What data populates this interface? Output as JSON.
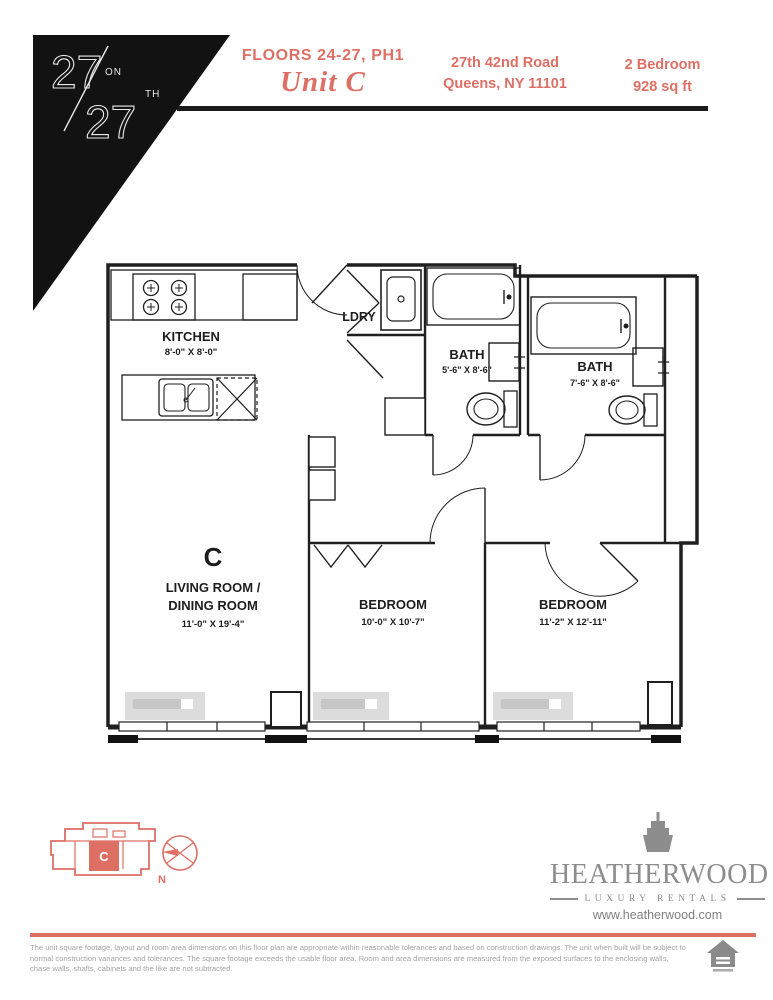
{
  "header": {
    "logo_num1": "27",
    "logo_sub1": "ON",
    "logo_num2": "27",
    "logo_sub2": "TH",
    "floors": "FLOORS 24-27, PH1",
    "unit": "Unit C",
    "address_line1": "27th 42nd Road",
    "address_line2": "Queens, NY 11101",
    "info_line1": "2 Bedroom",
    "info_line2": "928 sq ft"
  },
  "floorplan": {
    "kitchen": {
      "label": "KITCHEN",
      "dims": "8'-0\" X 8'-0\""
    },
    "laundry": {
      "label": "LDRY"
    },
    "bath1": {
      "label": "BATH",
      "dims": "5'-6\" X 8'-6\""
    },
    "bath2": {
      "label": "BATH",
      "dims": "7'-6\" X 8'-6\""
    },
    "living": {
      "unit_letter": "C",
      "label1": "LIVING ROOM /",
      "label2": "DINING ROOM",
      "dims": "11'-0\" X 19'-4\""
    },
    "bedroom1": {
      "label": "BEDROOM",
      "dims": "10'-0\" X 10'-7\""
    },
    "bedroom2": {
      "label": "BEDROOM",
      "dims": "11'-2\" X 12'-11\""
    }
  },
  "keyplan": {
    "unit_letter": "C",
    "compass_label": "N"
  },
  "footer": {
    "brand": "HEATHERWOOD",
    "tagline": "LUXURY RENTALS",
    "website": "www.heatherwood.com",
    "disclaimer": "The unit square footage, layout and room area dimensions on this floor plan are appropriate within reasonable tolerances and based on construction drawings. The unit when built will be subject to normal construction variances and tolerances. The square footage exceeds the usable floor area. Room and area dimensions are measured from the exposed surfaces to the enclosing walls, chase walls, shafts, cabinets and the like are not subtracted."
  },
  "colors": {
    "accent": "#dd6f65",
    "ink": "#1f1f1f",
    "gray_brand": "#8d8d8d",
    "gray_text": "#a3a3a3"
  }
}
